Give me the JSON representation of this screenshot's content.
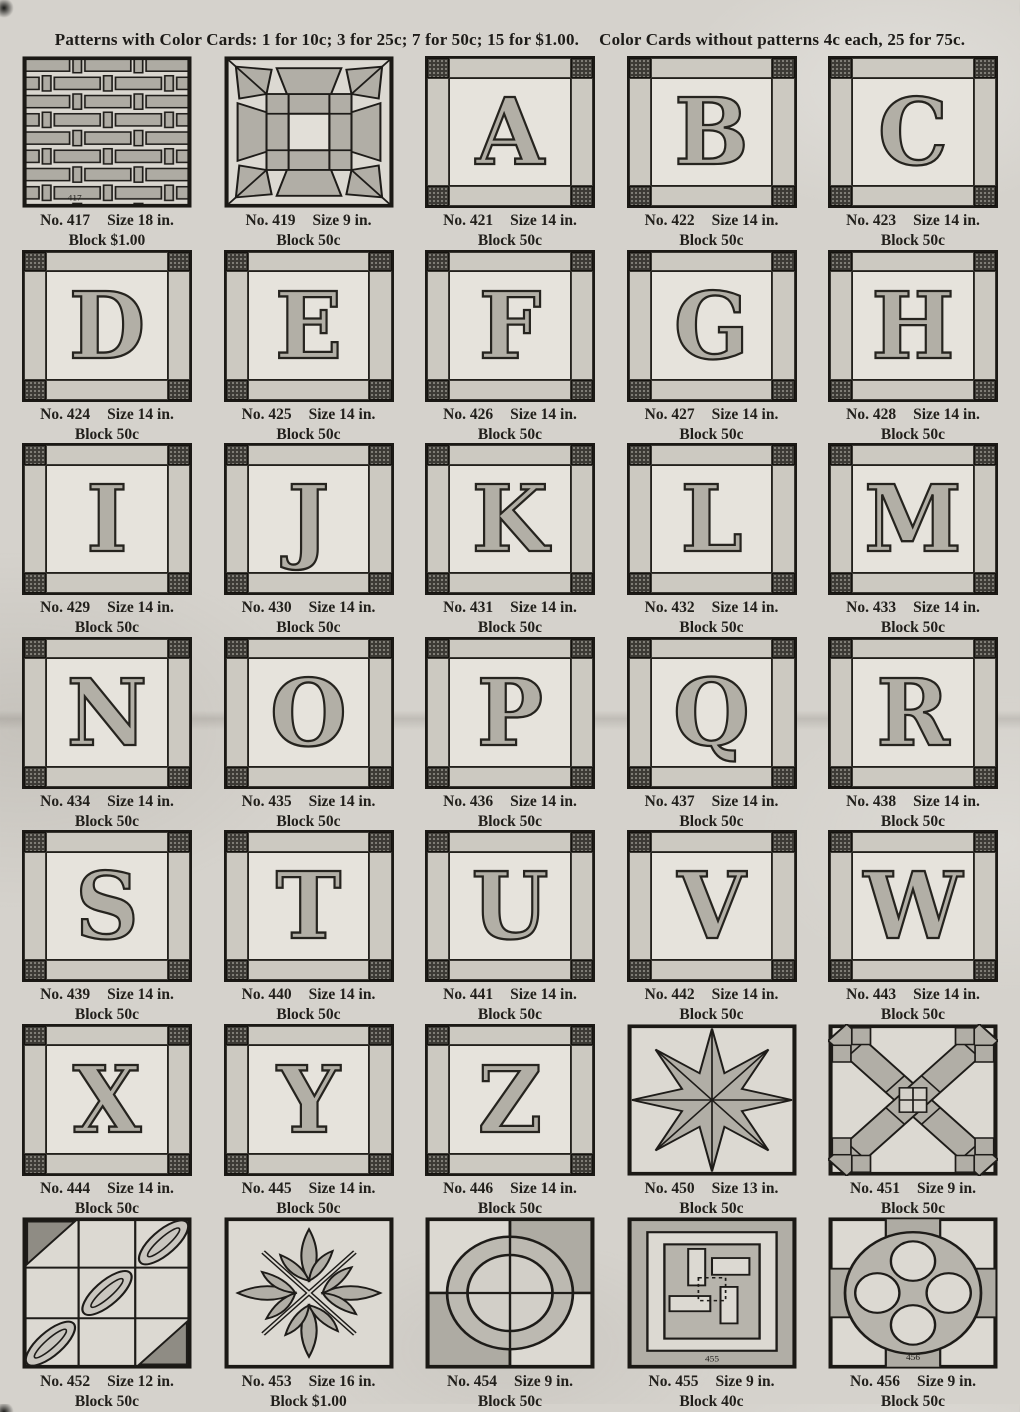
{
  "header": {
    "part1": "Patterns with Color Cards: 1 for 10c; 3 for 25c; 7 for 50c; 15 for $1.00.",
    "part2": "Color Cards without patterns 4c each, 25 for 75c."
  },
  "colors": {
    "paper": "#d5d2cc",
    "ink": "#1d1b18",
    "patch_light": "#dcd9d2",
    "patch_shade": "#b1aea6",
    "patch_dark": "#3c3a35"
  },
  "blocks": [
    {
      "no": "No. 417",
      "size": "Size 18 in.",
      "price": "Block $1.00",
      "design": "basketweave",
      "inset": "417"
    },
    {
      "no": "No. 419",
      "size": "Size 9 in.",
      "price": "Block 50c",
      "design": "star9"
    },
    {
      "no": "No. 421",
      "size": "Size 14 in.",
      "price": "Block 50c",
      "design": "letter",
      "letter": "A"
    },
    {
      "no": "No. 422",
      "size": "Size 14 in.",
      "price": "Block 50c",
      "design": "letter",
      "letter": "B"
    },
    {
      "no": "No. 423",
      "size": "Size 14 in.",
      "price": "Block 50c",
      "design": "letter",
      "letter": "C"
    },
    {
      "no": "No. 424",
      "size": "Size 14 in.",
      "price": "Block 50c",
      "design": "letter",
      "letter": "D"
    },
    {
      "no": "No. 425",
      "size": "Size 14 in.",
      "price": "Block 50c",
      "design": "letter",
      "letter": "E"
    },
    {
      "no": "No. 426",
      "size": "Size 14 in.",
      "price": "Block 50c",
      "design": "letter",
      "letter": "F"
    },
    {
      "no": "No. 427",
      "size": "Size 14 in.",
      "price": "Block 50c",
      "design": "letter",
      "letter": "G"
    },
    {
      "no": "No. 428",
      "size": "Size 14 in.",
      "price": "Block 50c",
      "design": "letter",
      "letter": "H"
    },
    {
      "no": "No. 429",
      "size": "Size 14 in.",
      "price": "Block 50c",
      "design": "letter",
      "letter": "I"
    },
    {
      "no": "No. 430",
      "size": "Size 14 in.",
      "price": "Block 50c",
      "design": "letter",
      "letter": "J"
    },
    {
      "no": "No. 431",
      "size": "Size 14 in.",
      "price": "Block 50c",
      "design": "letter",
      "letter": "K"
    },
    {
      "no": "No. 432",
      "size": "Size 14 in.",
      "price": "Block 50c",
      "design": "letter",
      "letter": "L"
    },
    {
      "no": "No. 433",
      "size": "Size 14 in.",
      "price": "Block 50c",
      "design": "letter",
      "letter": "M"
    },
    {
      "no": "No. 434",
      "size": "Size 14 in.",
      "price": "Block 50c",
      "design": "letter",
      "letter": "N"
    },
    {
      "no": "No. 435",
      "size": "Size 14 in.",
      "price": "Block 50c",
      "design": "letter",
      "letter": "O"
    },
    {
      "no": "No. 436",
      "size": "Size 14 in.",
      "price": "Block 50c",
      "design": "letter",
      "letter": "P"
    },
    {
      "no": "No. 437",
      "size": "Size 14 in.",
      "price": "Block 50c",
      "design": "letter",
      "letter": "Q"
    },
    {
      "no": "No. 438",
      "size": "Size 14 in.",
      "price": "Block 50c",
      "design": "letter",
      "letter": "R"
    },
    {
      "no": "No. 439",
      "size": "Size 14 in.",
      "price": "Block 50c",
      "design": "letter",
      "letter": "S"
    },
    {
      "no": "No. 440",
      "size": "Size 14 in.",
      "price": "Block 50c",
      "design": "letter",
      "letter": "T"
    },
    {
      "no": "No. 441",
      "size": "Size 14 in.",
      "price": "Block 50c",
      "design": "letter",
      "letter": "U"
    },
    {
      "no": "No. 442",
      "size": "Size 14 in.",
      "price": "Block 50c",
      "design": "letter",
      "letter": "V"
    },
    {
      "no": "No. 443",
      "size": "Size 14 in.",
      "price": "Block 50c",
      "design": "letter",
      "letter": "W"
    },
    {
      "no": "No. 444",
      "size": "Size 14 in.",
      "price": "Block 50c",
      "design": "letter",
      "letter": "X"
    },
    {
      "no": "No. 445",
      "size": "Size 14 in.",
      "price": "Block 50c",
      "design": "letter",
      "letter": "Y"
    },
    {
      "no": "No. 446",
      "size": "Size 14 in.",
      "price": "Block 50c",
      "design": "letter",
      "letter": "Z"
    },
    {
      "no": "No. 450",
      "size": "Size 13 in.",
      "price": "Block 50c",
      "design": "star8"
    },
    {
      "no": "No. 451",
      "size": "Size 9 in.",
      "price": "Block 50c",
      "design": "cross"
    },
    {
      "no": "No. 452",
      "size": "Size 12 in.",
      "price": "Block 50c",
      "design": "cable"
    },
    {
      "no": "No. 453",
      "size": "Size 16 in.",
      "price": "Block $1.00",
      "design": "leaf"
    },
    {
      "no": "No. 454",
      "size": "Size 9 in.",
      "price": "Block 50c",
      "design": "ring"
    },
    {
      "no": "No. 455",
      "size": "Size 9 in.",
      "price": "Block 40c",
      "design": "logcabin",
      "inset": "455"
    },
    {
      "no": "No. 456",
      "size": "Size 9 in.",
      "price": "Block 50c",
      "design": "quatrefoil",
      "inset": "456"
    }
  ]
}
